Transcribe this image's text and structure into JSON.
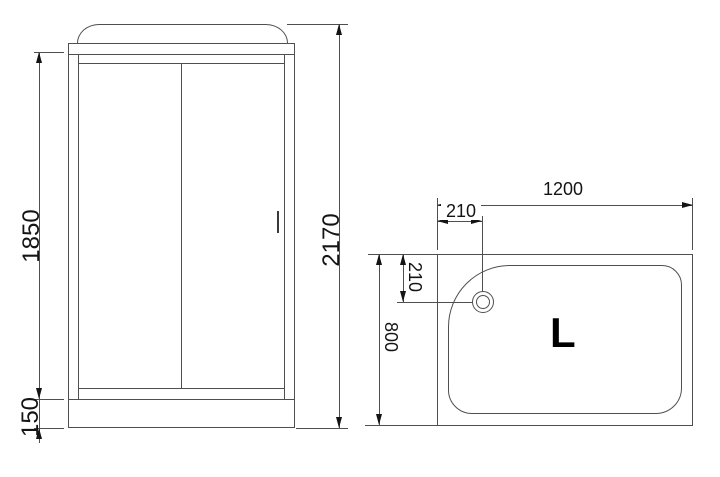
{
  "front_view": {
    "door_height": "1850",
    "base_height": "150",
    "total_height": "2170"
  },
  "top_view": {
    "width": "1200",
    "drain_offset_horizontal": "210",
    "drain_offset_vertical": "210",
    "depth": "800",
    "orientation_label": "L"
  },
  "colors": {
    "line": "#4f4f4f",
    "dimension_text": "#141414",
    "background": "#ffffff"
  }
}
